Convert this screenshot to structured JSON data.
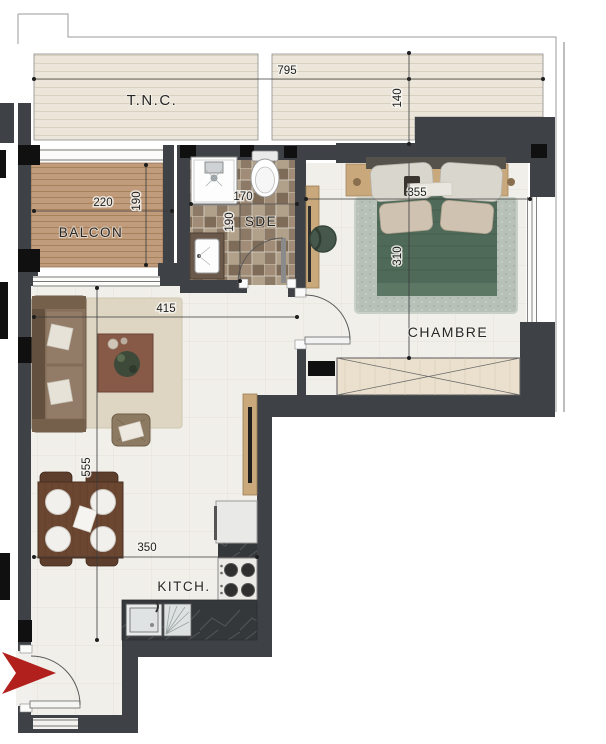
{
  "plan": {
    "rooms": {
      "tnc": "T.N.C.",
      "balcon": "BALCON",
      "sde": "SDE",
      "chambre": "CHAMBRE",
      "kitchen": "KITCH."
    },
    "dimensions": {
      "tnc_width": "795",
      "tnc_depth": "140",
      "balcon_width": "220",
      "balcon_depth": "190",
      "sde_width": "170",
      "sde_depth": "190",
      "bed_wall_width": "355",
      "chambre_depth": "310",
      "living_width": "415",
      "living_depth": "555",
      "kitchen_width": "350"
    },
    "colors": {
      "wall": "#3e4247",
      "column": "#101010",
      "tnc_floor": "#ece6da",
      "balcony_deck": "#c09b7c",
      "sde_tile": "#96836e",
      "living_floor": "#f1efea",
      "bedroom_rug": "#b7c1b8",
      "bed_duvet": "#4f6a58",
      "living_rug": "#ded6c3",
      "coffee_table": "#875947",
      "dining_table": "#6b4631",
      "wood_furniture": "#c9a87c",
      "kitchen_counter": "#35383b",
      "entry_arrow": "#b2201d",
      "dimension_line": "#3a3a3a"
    }
  }
}
